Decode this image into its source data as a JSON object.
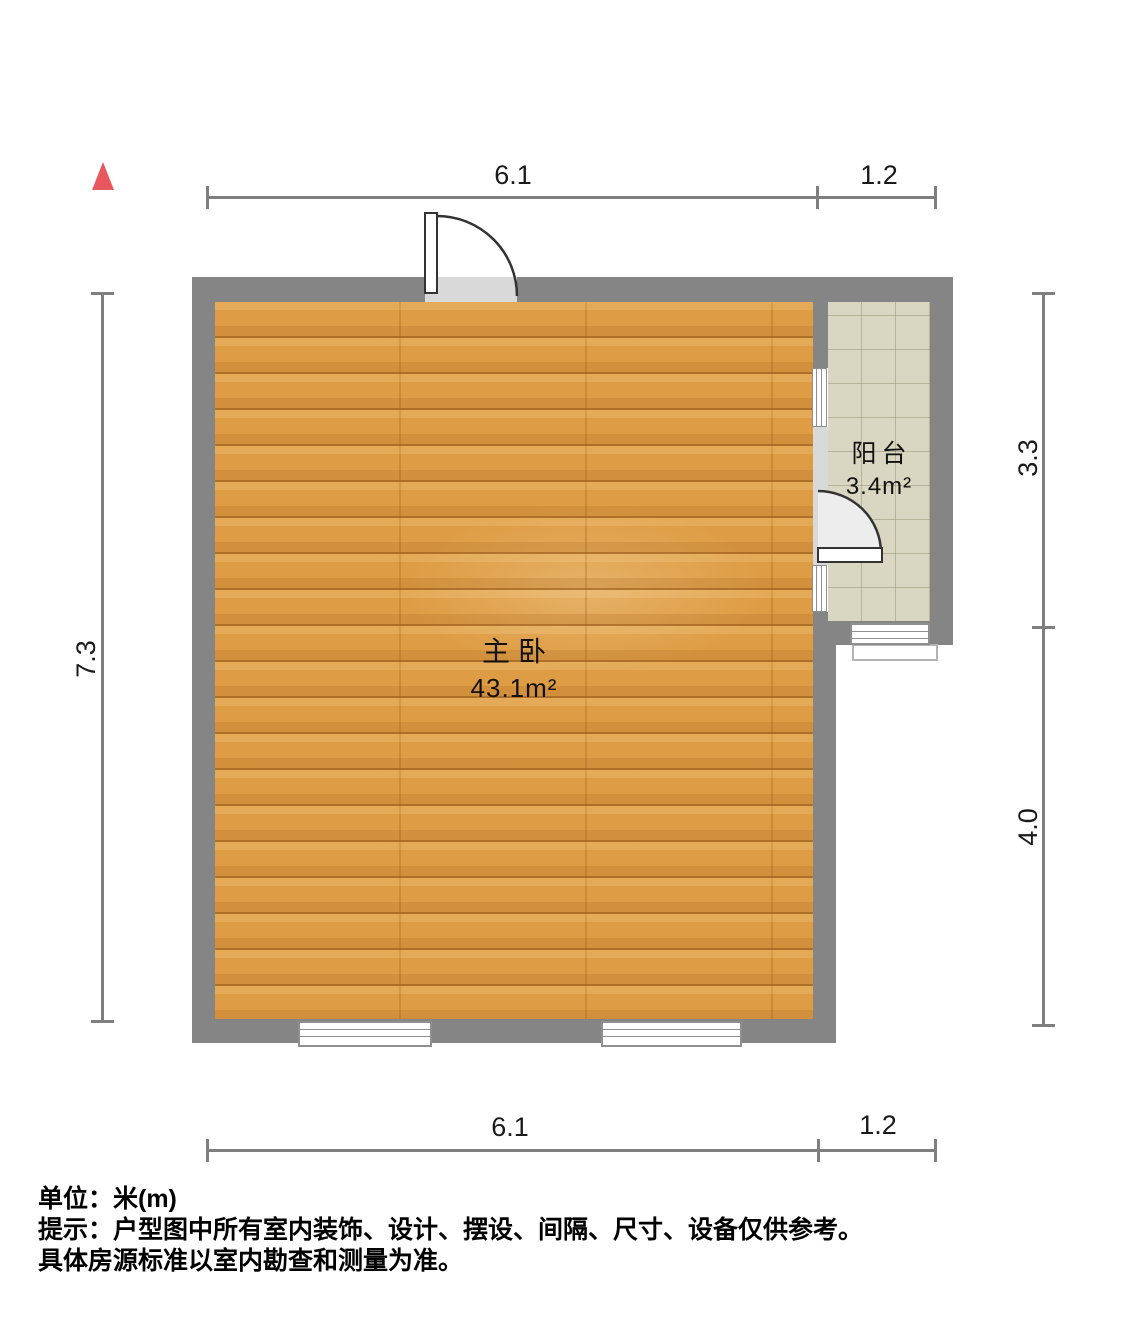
{
  "plan": {
    "rooms": {
      "master_bedroom": {
        "name": "主卧",
        "area": "43.1m²"
      },
      "balcony": {
        "name": "阳台",
        "area": "3.4m²"
      }
    },
    "dimensions": {
      "top": {
        "seg1": "6.1",
        "seg2": "1.2"
      },
      "bottom": {
        "seg1": "6.1",
        "seg2": "1.2"
      },
      "left": {
        "seg1": "7.3"
      },
      "right": {
        "seg1": "3.3",
        "seg2": "4.0"
      }
    },
    "north_arrow_icon": "north-arrow",
    "colors": {
      "wall": "#858585",
      "wood_floor": "#de9c44",
      "tile_floor": "#d9d6c1",
      "door_opening": "#d9d9d9",
      "north_arrow": "#e8575d",
      "dimension_line": "#7f7f7f"
    }
  },
  "footer": {
    "unit_label": "单位：米(m)",
    "note_line1": "提示：户型图中所有室内装饰、设计、摆设、间隔、尺寸、设备仅供参考。",
    "note_line2": "具体房源标准以室内勘查和测量为准。"
  }
}
